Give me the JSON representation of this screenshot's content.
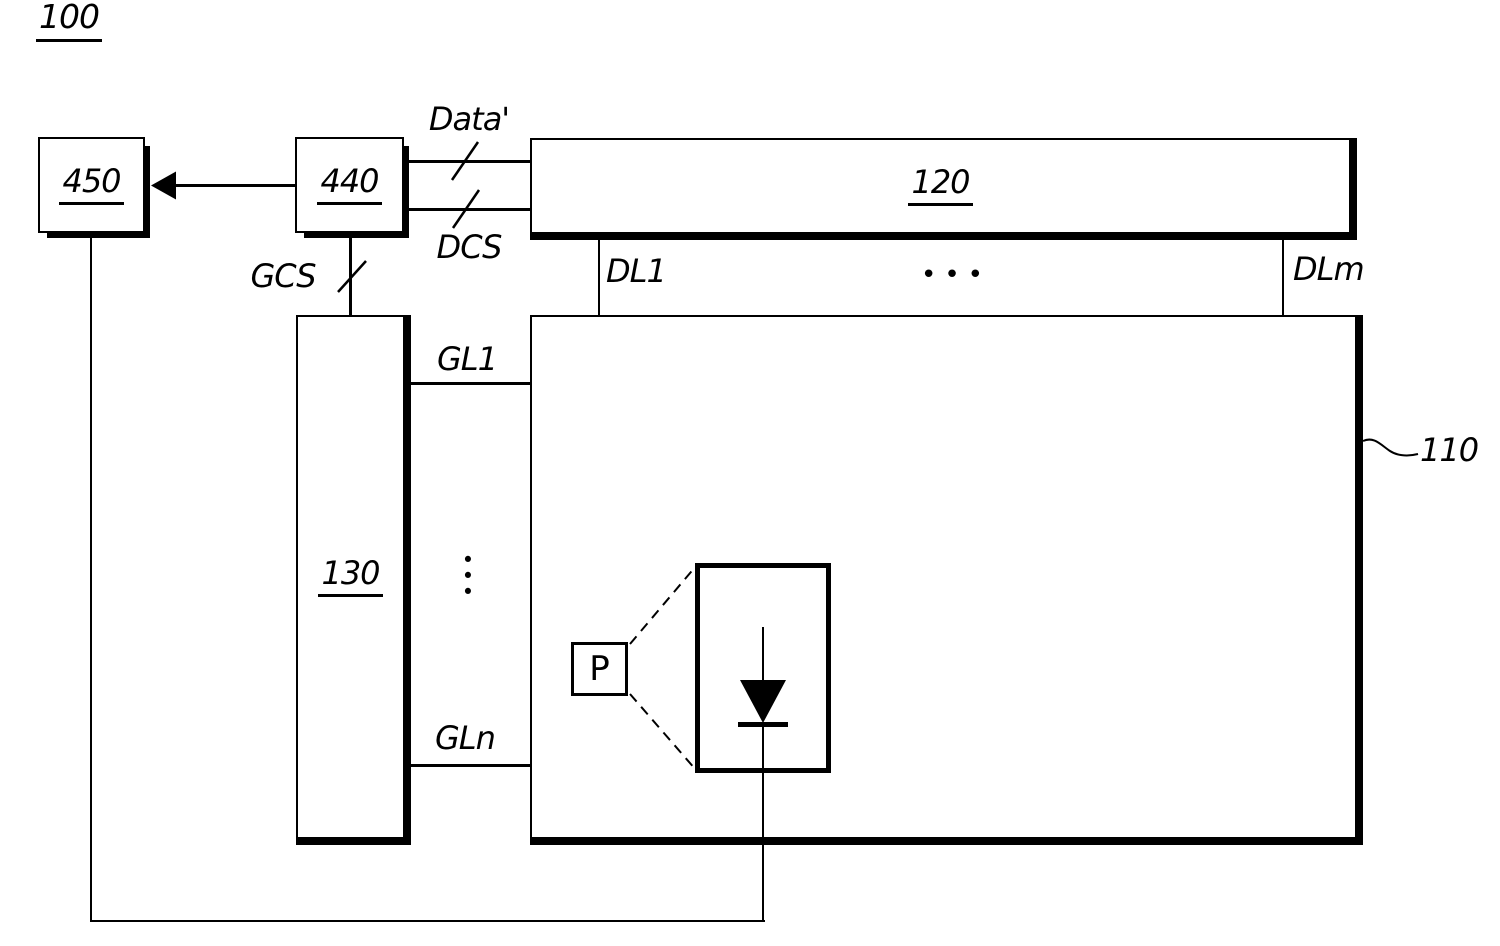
{
  "figure": {
    "ref": "100"
  },
  "blocks": {
    "b450": "450",
    "b440": "440",
    "b120": "120",
    "b130": "130",
    "b110": "110",
    "pixel_marker": "P"
  },
  "signals": {
    "data": "Data'",
    "dcs": "DCS",
    "gcs": "GCS",
    "dl1": "DL1",
    "dlm": "DLm",
    "gl1": "GL1",
    "gln": "GLn"
  },
  "ellipsis": {
    "horizontal": "•••",
    "vertical": "•\n•\n•"
  },
  "colors": {
    "ink": "#000000",
    "background": "#ffffff"
  }
}
